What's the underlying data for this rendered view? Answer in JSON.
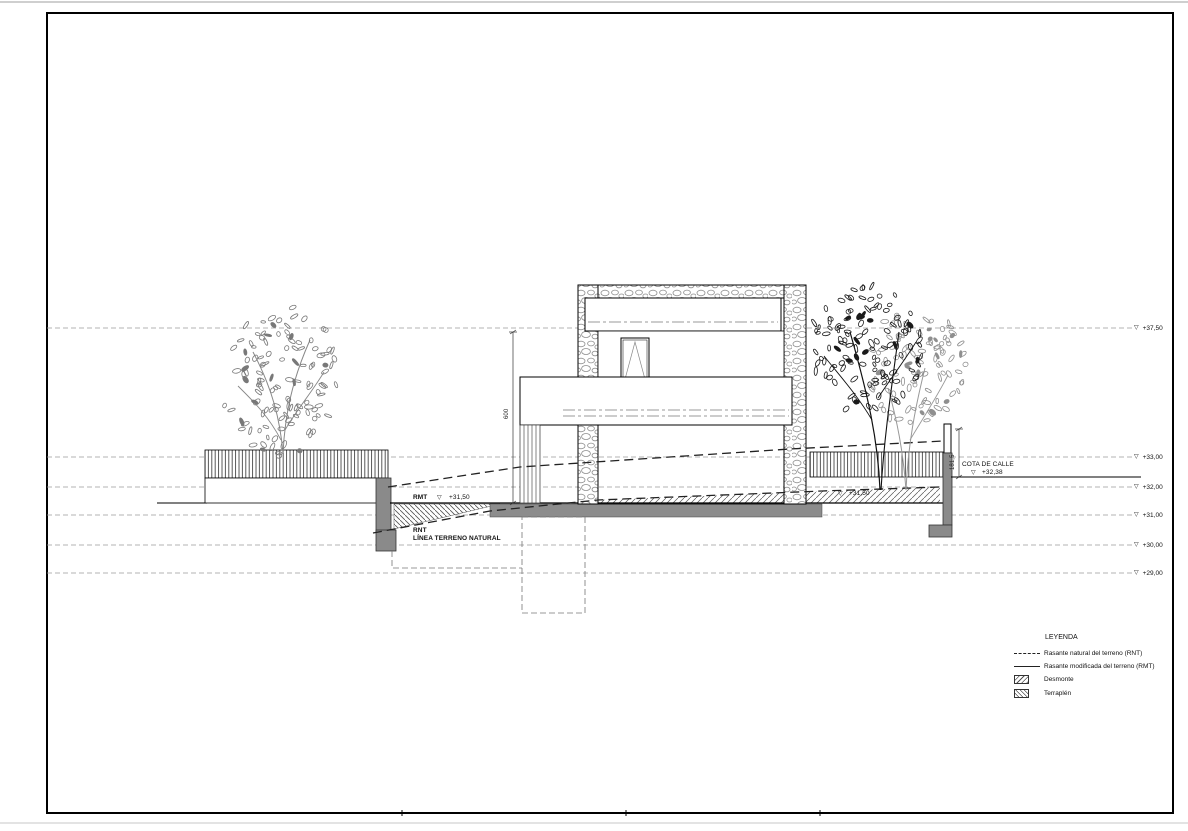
{
  "drawing_type": "architectural-section-elevation",
  "glyphs": {
    "level_marker": "▽"
  },
  "levels": [
    {
      "label": "+37,50"
    },
    {
      "label": "+33,00"
    },
    {
      "label": "+32,00"
    },
    {
      "label": "+31,00"
    },
    {
      "label": "+30,00"
    },
    {
      "label": "+29,00"
    }
  ],
  "annotations": {
    "rmt_label": "RMT",
    "rmt_value": "+31,50",
    "rnt_label": "RNT",
    "rnt_sub": "LÍNEA TERRENO NATURAL",
    "street_label": "COTA DE CALLE",
    "street_value": "+32,38",
    "right_rmt_value": "+31,50",
    "building_height_dim": "600",
    "fence_height_dim": "181,5"
  },
  "legend": {
    "title": "LEYENDA",
    "items": [
      {
        "symbol": "dashed-line",
        "label": "Rasante natural del terreno (RNT)"
      },
      {
        "symbol": "solid-line",
        "label": "Rasante modificada del terreno (RMT)"
      },
      {
        "symbol": "diagonal-hatch",
        "label": "Desmonte"
      },
      {
        "symbol": "back-diagonal-hatch",
        "label": "Terraplén"
      }
    ]
  },
  "colors": {
    "wall_gray": "#8a8a8a",
    "slab_gray": "#8c8c8c",
    "grid_line": "#9a9a9a",
    "ink": "#1a1a1a"
  }
}
